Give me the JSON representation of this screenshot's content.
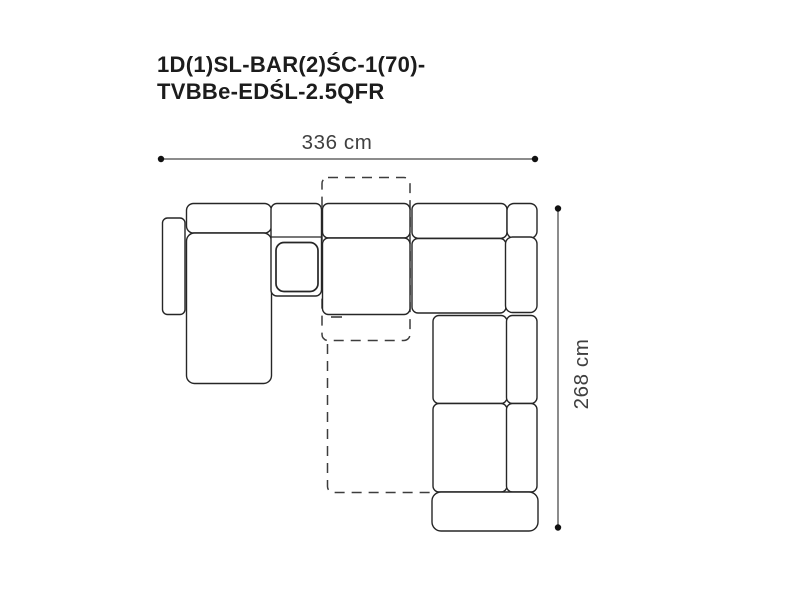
{
  "title": {
    "line1": "1D(1)SL-BAR(2)ŚC-1(70)-",
    "line2": "TVBBe-EDŚL-2.5QFR"
  },
  "dimensions": {
    "width_label": "336 cm",
    "height_label": "268 cm",
    "width_cm": 336,
    "height_cm": 268
  },
  "diagram": {
    "type": "corner-sofa-top-view-technical-drawing",
    "solid_parts": [
      "left-armrest",
      "chaise-backrest",
      "chaise-seat",
      "bar-module",
      "bar-module-inner",
      "middle-backrest",
      "middle-seat",
      "corner-backrest",
      "corner-block",
      "corner-seat",
      "right-backrest",
      "right-row1-seat",
      "right-row1-backrest",
      "right-row2-seat",
      "right-row2-backrest",
      "bottom-armrest"
    ],
    "dashed_parts": [
      "bed-extension-outline-top",
      "bed-extension-outline-bottom"
    ]
  },
  "colors": {
    "background": "#ffffff",
    "outline": "#262626",
    "dashed_outline": "#3d3d3d",
    "dimension_line": "#8c8c8c",
    "dimension_dot": "#111111",
    "dimension_text": "#3f3f3f",
    "title_text": "#1c1c1c"
  }
}
